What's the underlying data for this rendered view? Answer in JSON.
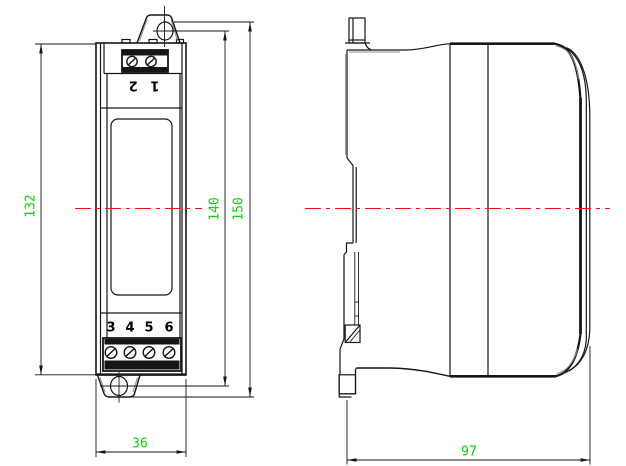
{
  "drawing": {
    "front_view": {
      "terminals_top_label": "1 2",
      "terminals_bottom": [
        "3",
        "4",
        "5",
        "6"
      ]
    },
    "dimensions": [
      {
        "id": "body-height",
        "value": "132",
        "orientation": "vertical"
      },
      {
        "id": "hole-spacing",
        "value": "140",
        "orientation": "vertical"
      },
      {
        "id": "overall-height",
        "value": "150",
        "orientation": "vertical"
      },
      {
        "id": "front-width",
        "value": "36",
        "orientation": "horizontal"
      },
      {
        "id": "side-depth",
        "value": "97",
        "orientation": "horizontal"
      }
    ],
    "colors": {
      "dimension_text": "#00d800",
      "centerline": "#ee1111",
      "line": "#161616"
    }
  }
}
